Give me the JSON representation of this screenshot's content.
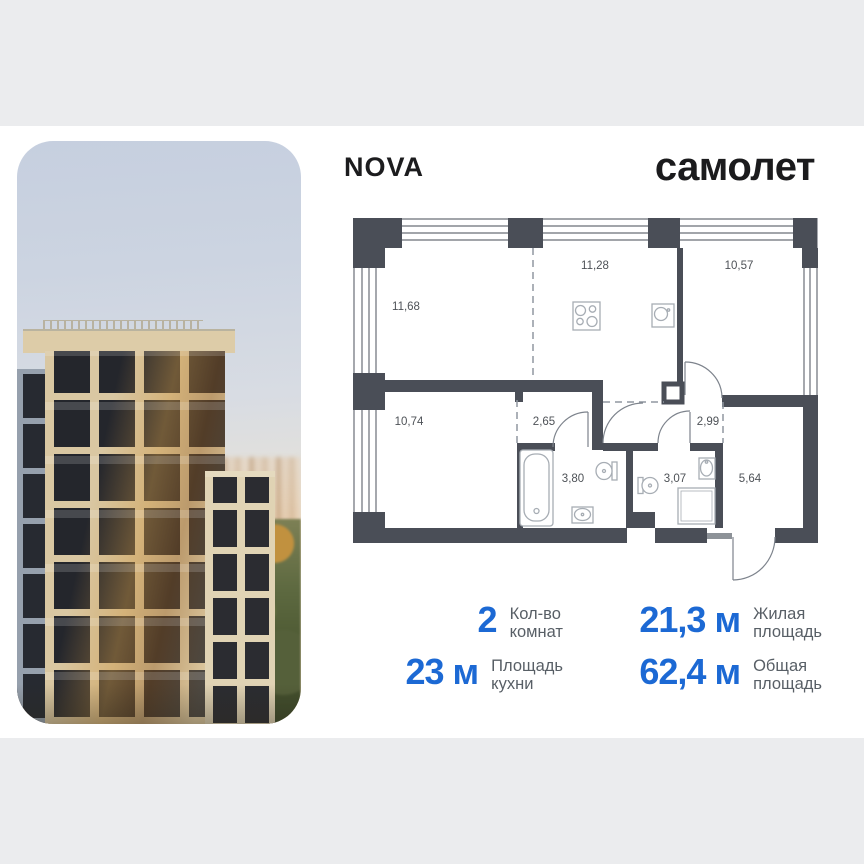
{
  "header": {
    "nova_logo": "NOVA",
    "brand_logo": "самолет"
  },
  "floor_plan": {
    "room_areas": [
      "11,68",
      "11,28",
      "10,57",
      "10,74",
      "2,65",
      "2,99",
      "3,80",
      "3,07",
      "5,64"
    ]
  },
  "stats": {
    "items": [
      {
        "value": "2",
        "label": [
          "Кол-во",
          "комнат"
        ]
      },
      {
        "value": "21,3 м",
        "label": [
          "Жилая",
          "площадь"
        ]
      },
      {
        "value": "23 м",
        "label": [
          "Площадь",
          "кухни"
        ]
      },
      {
        "value": "62,4 м",
        "label": [
          "Общая",
          "площадь"
        ]
      }
    ]
  },
  "colors": {
    "accent_blue": "#1c69d4",
    "wall_dark": "#4a4e57",
    "page_background": "#ebecee"
  }
}
